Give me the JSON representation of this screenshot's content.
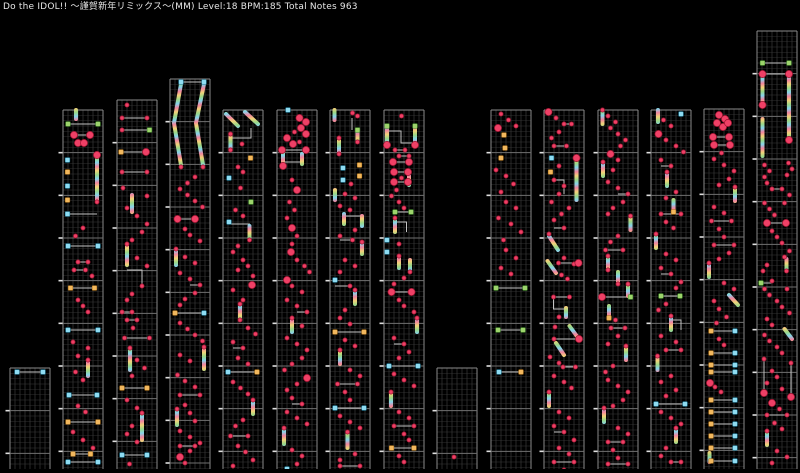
{
  "header": {
    "title": "Do the IDOL!! ～謹賀新年リミックス～(MM) Level:18 BPM:185 Total Notes 963"
  },
  "meta": {
    "song": "Do the IDOL!! ～謹賀新年リミックス～",
    "difficulty": "MM",
    "level": "18",
    "bpm": "185",
    "total_notes": "963"
  },
  "colors": {
    "background": "#000000",
    "tap_note": "#ef4066",
    "tap_note_edge": "#99132f",
    "cyan_note": "#8edcf2",
    "cyan_note_edge": "#2e8aa8",
    "yellow_note": "#f2b85e",
    "yellow_note_edge": "#b77b22",
    "green_note": "#9dd46c",
    "green_note_edge": "#4f9a33",
    "connector_line": "#c4c4c4",
    "grid_fine": "#252525",
    "grid_lane": "#3a3a3a",
    "grid_border": "#8a8a8a",
    "grid_measure": "#6f6f6f",
    "measure_tick": "#e0e0e0",
    "rainbow": [
      "#f2849e",
      "#f2d379",
      "#9ad887",
      "#86d4ec"
    ]
  },
  "legend": {
    "t": "small-tap-note",
    "T": "large-tap-note",
    "c": "cyan-flick-note",
    "y": "yellow-flick-note",
    "g": "green-flick-note",
    "L": "simultaneous-pair-line",
    "R": "rainbow-hold-bar",
    "S": "rainbow-slide-bar",
    "V": "vertical-hold-line",
    "P": "hold-path-line"
  },
  "grid": {
    "canvas_w": 800,
    "canvas_h": 469,
    "col_width": 40,
    "lane_px": 5,
    "row_px": 5.3333,
    "measure_px": 42.6667
  },
  "columns": [
    {
      "x": 10,
      "top": 368,
      "tokens": "c1.4:4 c6.6:4 L4:1.4-6.6"
    },
    {
      "x": 63,
      "top": 110,
      "tokens": "R2.6:0-9 g1:14 g7:14 L14:1-7 T2.2:25 T5.4:25 L25:2.2-5.4 T3:33 T4.2:33 T6.8:45 R6.8:47-90 c0.9:50 y0.9:62 c0.9:76 y0.9:90 c0.9:104 P0.9:104,6.8:104 t6.8:92 t4:118 t2.5:126 c1:136 c7:136 L136:1-7 t3:152 t5:152 L152:3-5 t2.2:160 t4.5:160 L160:2.2-4.5 t5.8:166 y1.5:178 y6.3:178 L178:1.5-6.3 t3:190 t4:196 t5:202 c1:220 c7:220 L220:1-7 t2:232 t5:238 t3:246 R5:252-266 t5:250 t2.5:262 t4:270 c1.2:285 c6.8:285 L285:1.2-6.8 t3:296 t4.5:302 y1:312 y7:312 L312:1-7 t2:322 t4:330 t6:338 y2:344 y5.5:344 L344:2-5.5 c1:352 c7:352 L352:1-7"
    },
    {
      "x": 117,
      "top": 100,
      "tokens": "t2:5 t1:18 t6:18 L18:1-6 t1:30 g6.5:30 L30:1-6.5 y0.8:52 T5.8:52 L52:0.8-5.8 t1:72 t6:72 L72:1-6 t1.2:88 R3:95-112 t6:96 t2:108 t4:116 t6:124 t5:132 t3:140 R2:146-165 t2:144 t4:158 t6:166 P2:170,5:170,5:185 t5:186 t3:194 t2:200 t1:212 t3:212 L212:1-3 t2:220 t4:220 L220:2-4 t3.2:228 t1.5:238 t6.5:238 L238:1.5-6.5 R2.6:250-270 t2.6:248 t4:260 t5.5:268 t3:276 y1:288 y6:288 L288:1-6 t2:300 t4:308 R5:315-340 t5:313 t3:326 t2:334 t4:342 c1:355 c6:355 L355:1-6 t2.5:364"
    },
    {
      "x": 170,
      "top": 79,
      "tokens": "c2.2:3 c6.8:3 L3:2.2-6.8 S2.2:5,0.8:44,2.2:86 S6.8:5,5.2:44,6.6:86 t2.2:88 t6.6:88 t5:98 t3.5:104 t2:110 t3.5:116 t5:122 t6.5:128 T1.5:140 T5:140 L140:1.5-5 t3:150 t4:156 t6:162 R1.2:172-186 t1.2:170 t3:178 t5:184 t2:194 t4:200 t6:206 L206:4-6 t5:214 t3:220 t2:226 y1:234 c6.8:234 L234:1-6.8 t2:244 t3.5:250 t5:256 t6.5:262 R6.8:270-290 t6.8:268 t2:276 t4:282 t1.5:296 t3:302 t5:308 t2:316 t6:316 L316:2-6 t3:326 t4:334 t5:342 R1.4:332-346 t1.4:330 t2:352 t4:358 t6:364 t2:367 t5:367 L367:2-5 T2:378 t4:372 t3:384"
    },
    {
      "x": 223,
      "top": 110,
      "tokens": "S0.6:4,3:16 S4.4:2,7:14 t1.5:24 R1.5:26-38 t1.5:40 P1.5:28,5.6:28,5.6:18 t3.8:34 y5.5:48 t3:57 t4:62 c1.2:68 t3.5:78 g5.6:92 t2.5:100 t4:106 c1.2:112 P1.2:114,5.3:114,5.3:126 R5.3:116-128 t5.3:130 t3:136 t2:142 t4:150 t5:156 T5.8:175 t3:160 t6:166 t2:180 t4:190 R3.4:196-208 t3.4:194 t3.4:210 t5:218 t6.5:224 t2:232 t4:238 L238:2-4 t3:248 t5:254 c1:262 y6.8:262 L262:1-6.8 t2:272 t3.5:278 t5:284 R6:292-304 t6:290 t4:310 t2.5:316 t1.5:326 t5:326 L326:1.5-5 t3:336 t4.5:342 t6:350 t2:356 t2:364 t6:364 L364:2-6"
    },
    {
      "x": 277,
      "top": 110,
      "tokens": "c2.2:0 T4.5:8 T5.8:12 t3.5:22 T4.8:18 T5.8:24 T2:28 T3.2:34 t4.5:32 T1:40 T5.8:40 L40:1-5.8 R1.2:42-52 R5:44-54 L52:1.2-5 T1.2:56 t3:70 T4:80 t2.5:92 t3.5:100 t2:108 T3:118 t4:126 T2.8:142 t3:134 t4:150 t5.5:156 t6.5:162 T2:170 t3:176 t5:182 t2:190 t4:196 t6:202 L202:4-6 R3:210-222 t3:208 t5:216 t2:228 t4:234 t6:240 t5:248 t3:254 t1.5:260 T6:268 t4:274 t2:280 t3:288 t5:294 L294:3-5 t2:302 t4:308 t6:314 R1.4:320-334 t1.4:318 t3:340 t5:346 t4:354 c2:359"
    },
    {
      "x": 330,
      "top": 110,
      "tokens": "R0.9:0-10 t4.5:3 t5.5:6 V4.4:8-20 g5.5:20 R5.5:22-30 t5.5:32 R1.8:30-42 t1.8:28 t1.8:44 c2.6:58 y5.9:55 c2.6:70 y5.9:66 t4.2:74 R1:80-90 t3:84 t5:88 t2:96 t4:100 R2.8:104-114 R6.4:106-116 P2.8:106,6.4:106 t5:120 t2:126 t4.5:130 L130:2-4.5 R6.4:134-144 t6.4:132 t3:150 t5:156 t2:162 c1:170 t4:176 L176:1-4 R5:182-194 t5:180 t3:200 t2:208 t4:214 y1:222 y6.8:222 L222:1-6.8 t3:230 t5:236 R2:242-254 t2:240 t4:260 t6:266 t1.5:274 t5.5:274 L274:1.5-5.5 t3:282 t4:290 c1:298 c6.8:298 L298:1-6.8 t2:306 t4:312 t6:318 R3.5:324-338 t3.5:322 t5:344 t2:350 t2:356 t6:356 L356:2-6"
    },
    {
      "x": 384,
      "top": 110,
      "tokens": "t3.5:6 g0.6:16 g6.2:16 R0.6:18-33 R6.2:18-33 T0.6:35 T6.2:35 P0.6:21,3.4:21,3.4:33,6.2:33 t2.2:40 t4.2:40 L40:2.2-4.2 t3:46 t5:46 L46:3-5 T1.8:52 T5:52 L52:1.8-5 T2:62 T4.8:62 L62:2-4.8 R5:66-75 t3.5:68 T2:72 T4.8:72 L72:2-4.8 t2.5:80 t1.5:86 t3:92 t4:98 g2.2:102 g5.4:102 L102:2.2-5.4 R2.2:110-122 t2.2:108 P2.2:112,4.5:112,4.5:122 c0.6:130 t3:134 c0.6:142 R3:148-158 R5.2:150-160 t3:146 t5.2:162 t4:168 t2:174 T1.5:182 T5.5:182 L182:1.5-5.5 t3:190 t4:196 t6:202 R6.6:210-222 t6.6:208 t2:228 t4:234 L234:2-4 t5:242 t3:248 c1:256 c6.8:256 L256:1-6.8 t2:264 t4:270 t6:276 R1.4:284-296 t1.4:282 t3:302 t5:308 t2:316 t6:316 L316:2-6 t4:324 t5:330 y1.5:338 y6:338 L338:1.5-6 t3:346 t4:352"
    },
    {
      "x": 437,
      "top": 368,
      "tokens": "t3.4:89"
    },
    {
      "x": 491,
      "top": 110,
      "tokens": "t2:4 t3.5:10 T1.4:18 t5:16 y2.6:25 y2.8:38 y2:48 t1:60 t3:66 t4.5:74 t2:82 t3:92 t5:98 t1.5:108 t4:114 t6:122 t2.5:130 t3:140 t5:148 t2:158 t4:164 g1:178 g6.8:178 L178:1-6.8 g1.4:220 g6.4:220 L220:1.4-6.4 c1.6:262 y6:262 L262:1.6-6"
    },
    {
      "x": 544,
      "top": 110,
      "tokens": "T0.9:2 t2.4:8 t4:14 t5.5:14 L14:4-5.5 t3:22 t1.5:28 t2:36 t4.5:36 L36:2-4.5 T6.5:48 R6.5:50-90 c1.5:48 y1.3:62 t3:56 t2:70 t4:76 P2:70,4:70,4:84 t3:84 t1.5:92 t5:98 t3.5:104 t2:110 t4:118 L118:2-4 S1:126,2.8:140 t1:124 t4:148 t6:154 S0.7:151,2.4:163 t2.9:153 T6.9:153 L153:2.9-6.9 t3.5:165 t4.7:169 t1.9:187 t5.1:187 L187:1.9-5.1 P1.9:189,1.9:199,4:199 R4.4:198-207 t3:207 S5.1:216,6.7:227 t2.2:217 t2:229 T7:229 L229:2-7 S2.4:233,4:245 t1.2:247 t3:253 t3.8:257 t6.3:257 L257:3.8-6.3 t2:266 t4:272 t5.5:278 R1:284-296 t1:282 t3:302 t5:308 t2:316 t4:322 L322:2-4 t6:330 t3:338 t5:344 t2:352 t6:352 L352:2-6 t4:360"
    },
    {
      "x": 598,
      "top": 110,
      "tokens": "R0.9:2-14 t0.9:0 t2:6 t3.5:12 t2.5:18 t4:24 t5.5:30 t4.5:36 T2.5:44 t4:50 R1:54-66 t1:52 t3:60 t2:72 t4:78 t6:84 L84:4-6 t5:92 t3:98 t2:104 R6.5:108-120 t6.5:106 t4:126 t2.5:132 t1.5:140 t5:140 L140:1.5-5 R2:148-158 t2:146 t2:160 R4:162-172 t4:174 R6:176-186 t6:174 T0.8:187 g6.5:187 L187:0.8-6.5 R2.2:196-206 y2.2:208 t3.5:210 t2.6:218 t5.4:218 L218:2.6-5.4 t4:226 t2:234 R5.6:238-250 t5.6:236 t3:256 t1.5:262 t2:270 t4:276 t6:282 t5:290 t3:296 R1.2:300-312 t1.2:298 t4:318 t6:324 t2:332 t5:332 L332:2-5 t3:340 t4:348 t2:354 t6:354 L354:2-6"
    },
    {
      "x": 651,
      "top": 110,
      "tokens": "R1.4:0-12 c6:4 t2.5:10 t4:16 T1.5:24 t3:30 t5:36 t6.5:42 t2:50 t4:56 L56:2-4 R3.2:64-76 t3.2:62 t5:82 t3:88 R4.5:90-100 y4.5:102 t2:104 t6:104 L104:2-6 t3:112 t4.5:118 R1:126-138 t1:124 t3:144 t5:150 t2:158 t4:164 L164:2-4 t6:172 t5:178 g2:186 g5.8:186 L186:2-5.8 t3:194 t1.5:200 R4:208-220 t4:206 P4:210,6:210,6:220 t2:226 t5:232 t3:240 t6:240 L240:3-6 R1.3:248-260 t1.3:246 t4:266 t2:272 t5:280 t3:286 c1:294 c6.8:294 L294:1-6.8 t2:302 t4:308 t6:314 R5:320-332 t5:318 t3:338 t2:346 t4:352 t6:352 L352:4-6"
    },
    {
      "x": 704,
      "top": 109,
      "tokens": "T3:6 T4.2:10 T2.6:14 T3.8:18 T4.8:14 T1.8:28 T5:28 L28:1.8-5 T2:36 T5.2:36 L36:2-5.2 t3.5:44 t2:50 t4:56 t6:62 t5:70 t3:76 R6.2:80-92 t6.2:78 t2:98 t4:104 t1.5:112 t5.5:112 L112:1.5-5.5 t3:120 t4:128 t2:136 t6:136 L136:2-6 t5:144 t3:150 R1:156-168 t1:154 t4:174 t6:180 S5:186,6.8:196 t2:192 t3:200 t4.5:208 t2.5:214 y1.4:222 c6.2:222 L222:1.4-6.2 t3:230 t4:236 y1.4:244 c6.2:244 L244:1.4-6.2 y1.4:256 c6.2:256 L256:1.4-6.2 y1.4:263 c6.2:263 L263:1.4-6.2 T1.2:274 t2.2:278 t3.4:283 y1.4:291 c6.2:291 L291:1.4-6.2 y1.4:303 c6.2:303 L303:1.4-6.2 y1.4:315 c6.2:315 L315:1.4-6.2 y1.4:327 c6.2:327 L327:1.4-6.2 y1.4:339 c6.2:339 L339:1.4-6.2 R1.1:344-353 y1.4:352 c6.2:352 L352:1.4-6.2"
    },
    {
      "x": 757,
      "top": 31,
      "tokens": "g1.1:32 g6.4:32 L32:1.1-6.4 T1.1:43 T6.4:43 L43:1.1-6.4 R1.1:45-73 T1.1:74 R6.4:45-108 T6.4:109 R1.1:88-125 t1.5:134 t2.5:140 t1.5:146 t6.3:132 t7:138 t6:144 t2:152 t3:158 t5:158 L158:3-5 t6.5:164 t1.5:172 t2.5:178 t3.5:184 t5.5:172 T2:192 T5.8:192 L192:2-5.8 t3:200 t4:206 t5:212 t6.5:220 t5.5:226 R5.9:228-238 t5.9:240 t2:234 t1.2:240 g0.8:252 t3:250 L252:0.8-3 t1.5:258 t2.5:264 t6:258 t4:270 t5:276 t6.5:282 t2:288 t3:294 S5.5:298,7:308 t1.5:304 t2.5:310 t4:316 t5:322 V1.4:330-360 t1.4:328 T1.4:362 V6.8:334-364 t6.8:332 T6.8:366 t3:340 t4:346 t2:352 t5:358 T3:372 t4.5:378 t2:384 t6:384 L384:2-6 t3.5:392 t5:398 R2:402-414 t2:400 t4:420 t6:426 t3:432"
    }
  ]
}
